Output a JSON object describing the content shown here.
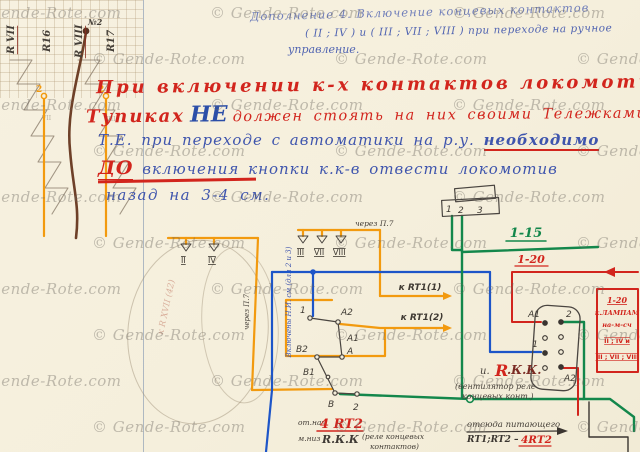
{
  "watermark": {
    "text": "© Gende-Rote.com"
  },
  "header_note": {
    "line1": "Дополнение 4. Включение концевых контактов",
    "line2": "( II ; IV ) и ( III ; VII ; VIII ) при переходе на ручное",
    "line3": "управление."
  },
  "warning": {
    "line1": "При включении к-х контактов локомотива в",
    "line2_pre": "Тупиках",
    "line2_ne": "НЕ",
    "line2_post": "должен стоять на них своими Тележками.",
    "line3_pre": "Т.Е. при переходе с автоматики на р.у. ",
    "line3_underlined": "необходимо",
    "line4_do": "ДО",
    "line4_post": " включения кнопки к.к-в отвести локомотив",
    "line5": "назад на 3-4 см."
  },
  "top_left_labels": {
    "r7": "R VII",
    "r16": "R16",
    "r8": "R VIII",
    "n2": "№2",
    "r17": "R17",
    "t2a": "2",
    "t2b": "2",
    "pm1": "VII",
    "pm2": "VIII"
  },
  "contact_groups": {
    "g1": [
      "II",
      "IV"
    ],
    "g2": [
      "III",
      "VII",
      "VIII"
    ],
    "via_p7": "через П.7",
    "via_p7_vert": "через П.7",
    "blue_note": "Включены Н.И. см (для 2 и 3)"
  },
  "switch_labels": {
    "n1": "1",
    "a2": "A2",
    "a1": "A1",
    "a": "A",
    "b2": "B2",
    "b1": "B1",
    "b": "B",
    "n2": "2"
  },
  "arrow_labels": {
    "rt1_1": "к RT1(1)",
    "rt1_2": "к RT1(2)"
  },
  "wire_labels": {
    "green": "1-15",
    "red": "1-20"
  },
  "relay_sketch": {
    "pins": [
      "1",
      "2",
      "3"
    ]
  },
  "connector": {
    "a1": "A1",
    "p2": "2",
    "p1": "1",
    "a2": "A2"
  },
  "rkk": {
    "prefix": "и.",
    "r": "R",
    "kk": ".К.К.",
    "note1": "(вентилятор реле",
    "note2": "концевых конт.)"
  },
  "red_box": {
    "l1": "1-20",
    "l2": "к.ЛАМПАМ",
    "l3": "на-м-сч",
    "l4": "II ; IV и",
    "l5": "III ; VII ; VIII"
  },
  "bottom_left": {
    "small1": "от.нач",
    "big1": "4 RT2",
    "small2": "м.низ",
    "big2": "R.К.К",
    "note1": "(реле концевых",
    "note2": "контактов)"
  },
  "bottom_right": {
    "l1": "отсюда питающего",
    "l2": "RT1;RT2 –",
    "l3": "4RT2"
  },
  "pencil_notes": {
    "faint1": "к R XVII (42)"
  },
  "colors": {
    "orange": "#f29a0f",
    "blue": "#1d55c8",
    "green": "#13874b",
    "red": "#d2251d",
    "brown": "#6e4028",
    "ink_blue": "#3f55ad",
    "pencil": "#575048"
  }
}
